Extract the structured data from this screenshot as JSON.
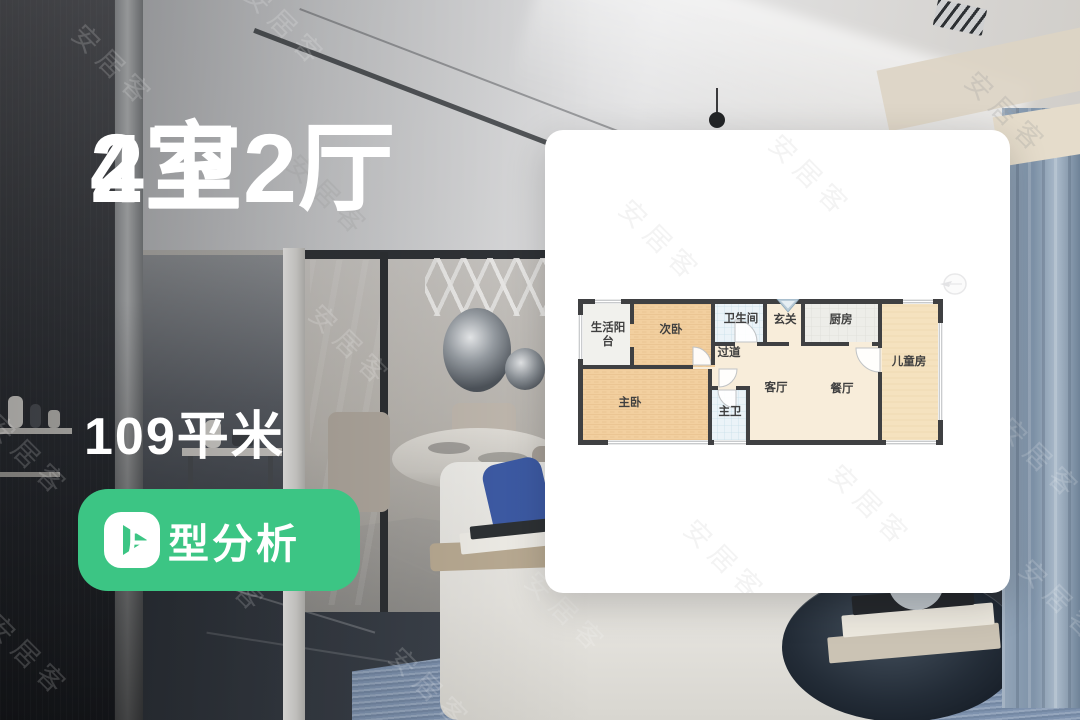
{
  "page_type": "real-estate-listing-cover",
  "overlay": {
    "headline_line1": "4室2厅",
    "headline_line2": "2卫",
    "area_text": "109平米",
    "analysis_button_label": "户型分析"
  },
  "watermark_text": "安居客",
  "colors": {
    "accent_green": "#3cc584",
    "wall": "#3f4042",
    "bedroom_fill": "#f2cf9f",
    "kids_room_fill": "#f5e2bf",
    "hall_fill": "#f8edda",
    "bath_fill": "#ebf3f8",
    "kitchen_fill": "#ededE9"
  },
  "floorplan": {
    "rooms": [
      {
        "id": "living-balcony",
        "label": "生活阳台"
      },
      {
        "id": "second-bedroom",
        "label": "次卧"
      },
      {
        "id": "bathroom",
        "label": "卫生间"
      },
      {
        "id": "entryway",
        "label": "玄关"
      },
      {
        "id": "kitchen",
        "label": "厨房"
      },
      {
        "id": "kids-room",
        "label": "儿童房"
      },
      {
        "id": "corridor",
        "label": "过道"
      },
      {
        "id": "master-bedroom",
        "label": "主卧"
      },
      {
        "id": "master-bathroom",
        "label": "主卫"
      },
      {
        "id": "living-room",
        "label": "客厅"
      },
      {
        "id": "dining-room",
        "label": "餐厅"
      }
    ]
  }
}
